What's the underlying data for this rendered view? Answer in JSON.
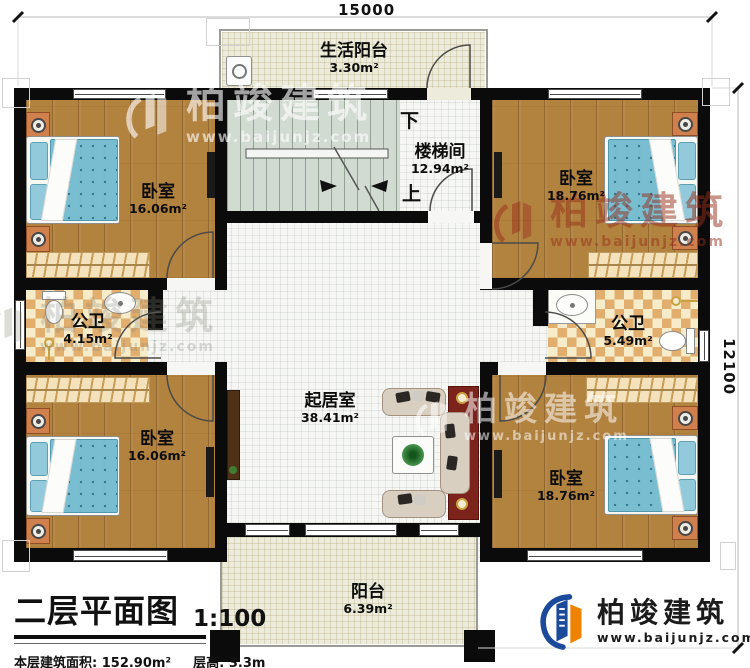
{
  "dimensions": {
    "width_mm": "15000",
    "height_mm": "12100"
  },
  "rooms": {
    "life_balcony": {
      "name": "生活阳台",
      "area": "3.30m²"
    },
    "stairwell": {
      "name": "楼梯间",
      "area": "12.94m²"
    },
    "bedroom_top_left": {
      "name": "卧室",
      "area": "16.06m²"
    },
    "bedroom_top_right": {
      "name": "卧室",
      "area": "18.76m²"
    },
    "bath_left": {
      "name": "公卫",
      "area": "4.15m²"
    },
    "bath_right": {
      "name": "公卫",
      "area": "5.49m²"
    },
    "living_room": {
      "name": "起居室",
      "area": "38.41m²"
    },
    "bedroom_bottom_left": {
      "name": "卧室",
      "area": "16.06m²"
    },
    "bedroom_bottom_right": {
      "name": "卧室",
      "area": "18.76m²"
    },
    "balcony": {
      "name": "阳台",
      "area": "6.39m²"
    }
  },
  "stairs": {
    "down": "下",
    "up": "上"
  },
  "title_block": {
    "title": "二层平面图",
    "scale": "1:100",
    "floor_area": "本层建筑面积: 152.90m²",
    "floor_height": "层高: 3.3m"
  },
  "brand": {
    "name": "柏竣建筑",
    "url": "www.baijunjz.com"
  },
  "colors": {
    "wall": "#0b0b0b",
    "wood_floor": "#b2823f",
    "tile": "#e2ae6e",
    "brand_blue": "#1b4a9b",
    "brand_orange": "#ef8200",
    "watermark_red": "#962d19"
  }
}
